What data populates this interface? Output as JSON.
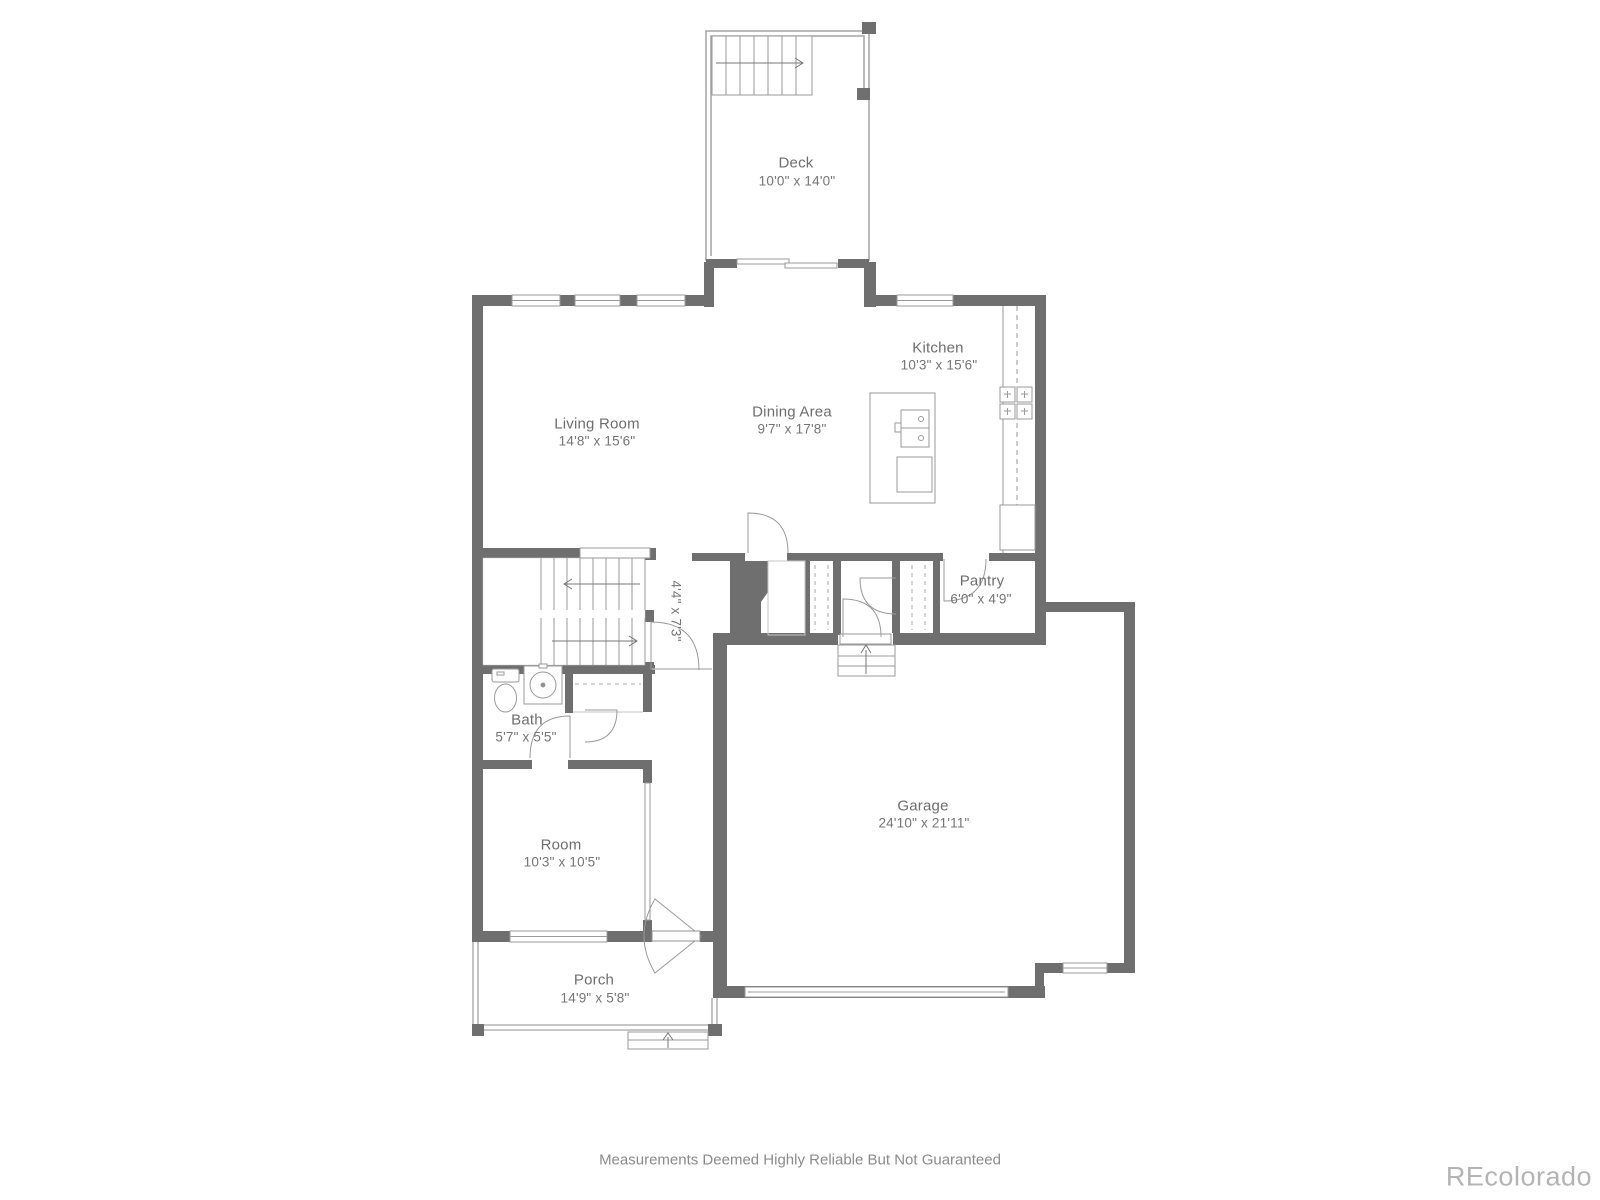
{
  "rooms": {
    "deck": {
      "name": "Deck",
      "dims": "10'0\" x 14'0\""
    },
    "living_room": {
      "name": "Living Room",
      "dims": "14'8\" x 15'6\""
    },
    "dining_area": {
      "name": "Dining Area",
      "dims": "9'7\" x 17'8\""
    },
    "kitchen": {
      "name": "Kitchen",
      "dims": "10'3\" x 15'6\""
    },
    "pantry": {
      "name": "Pantry",
      "dims": "6'0\" x 4'9\""
    },
    "stairwell": {
      "dims": "4'4\" x 7'3\""
    },
    "bath": {
      "name": "Bath",
      "dims": "5'7\" x 5'5\""
    },
    "room": {
      "name": "Room",
      "dims": "10'3\" x 10'5\""
    },
    "garage": {
      "name": "Garage",
      "dims": "24'10\" x 21'11\""
    },
    "porch": {
      "name": "Porch",
      "dims": "14'9\" x 5'8\""
    }
  },
  "footer": {
    "disclaimer": "Measurements Deemed Highly Reliable But Not Guaranteed"
  },
  "watermark": {
    "text": "REcolorado"
  },
  "colors": {
    "wall": "#6f6f6f",
    "thin_line": "#9a9a9a",
    "label": "#6e6e6e",
    "watermark": "#b4b4b4"
  }
}
